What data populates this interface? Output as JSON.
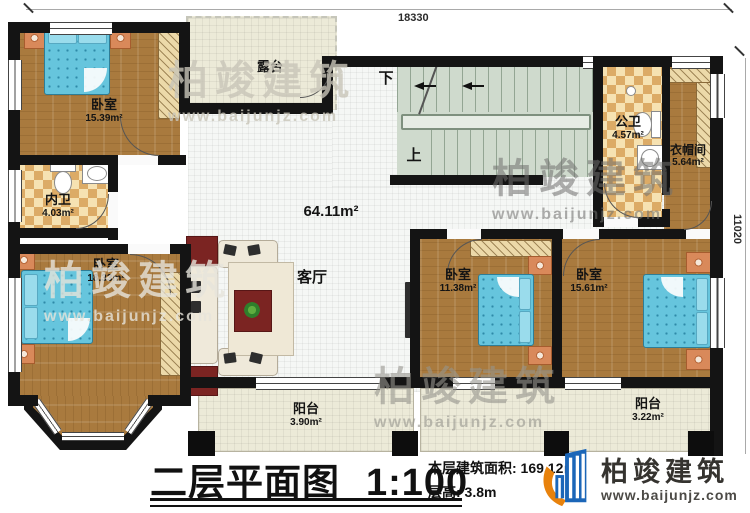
{
  "dimensions": {
    "top": "18330",
    "right": "11020"
  },
  "rooms": {
    "terrace": {
      "name": "露台"
    },
    "bedroom_top_left": {
      "name": "卧室",
      "area": "15.39m²"
    },
    "inner_bath": {
      "name": "内卫",
      "area": "4.03m²"
    },
    "bedroom_bottom_left": {
      "name": "卧室",
      "area": "18.33m²"
    },
    "living": {
      "name": "客厅",
      "area": "64.11m²"
    },
    "stairs": {
      "down": "下",
      "up": "上"
    },
    "public_bath": {
      "name": "公卫",
      "area": "4.57m²"
    },
    "cloakroom": {
      "name": "衣帽间",
      "area": "5.64m²"
    },
    "bedroom_mid_right": {
      "name": "卧室",
      "area": "11.38m²"
    },
    "bedroom_right": {
      "name": "卧室",
      "area": "15.61m²"
    },
    "balcony_center": {
      "name": "阳台",
      "area": "3.90m²"
    },
    "balcony_right": {
      "name": "阳台",
      "area": "3.22m²"
    }
  },
  "title_block": {
    "title": "二层平面图",
    "scale": "1:100",
    "floor_area": "本层建筑面积: 169.12㎡",
    "floor_height": "层高: 3.8m"
  },
  "branding": {
    "company": "柏竣建筑",
    "website": "www.baijunjz.com"
  },
  "colors": {
    "wall": "#141414",
    "wood": "#a97a3e",
    "tile_cream": "#ecead8",
    "checker_tan": "#dcab66",
    "stair_green": "#cfdacd",
    "bed_blue": "#66c5dd",
    "logo_blue": "#1b66b8",
    "logo_orange": "#e8820c"
  }
}
